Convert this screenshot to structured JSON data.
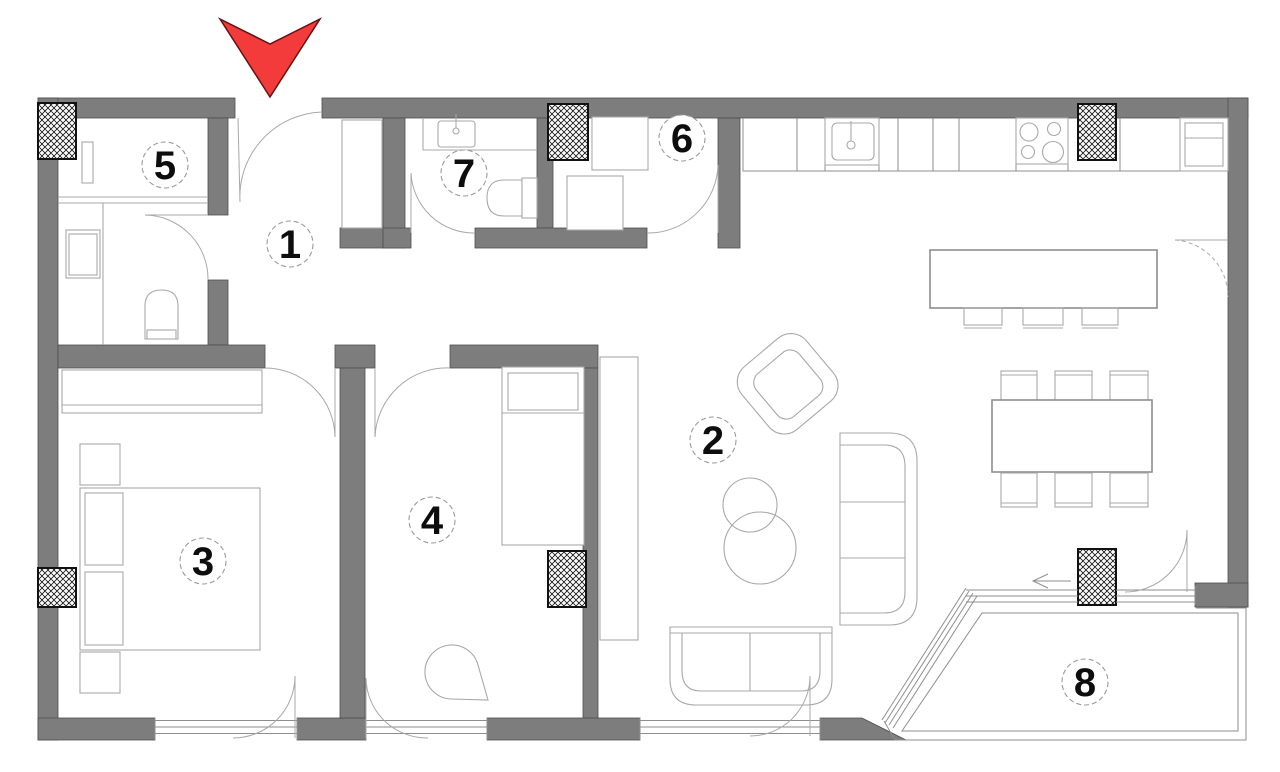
{
  "colors": {
    "bg": "#ffffff",
    "wall": "#7d7d7d",
    "wallEdge": "#4e4e4e",
    "line": "#a8a8a8",
    "lineSoft": "#8e8e8e",
    "hatch": "#111111",
    "arrow": "#f43b3b",
    "arrowEdge": "#641111",
    "labelText": "#0d0d0d",
    "labelRing": "#9a9a9a"
  },
  "icons": {
    "entrance_arrow": "red downward entrance arrow",
    "slide_arrow": "left sliding-door direction arrow"
  },
  "rooms": [
    {
      "number": "1"
    },
    {
      "number": "2"
    },
    {
      "number": "3"
    },
    {
      "number": "4"
    },
    {
      "number": "5"
    },
    {
      "number": "6"
    },
    {
      "number": "7"
    },
    {
      "number": "8"
    }
  ]
}
